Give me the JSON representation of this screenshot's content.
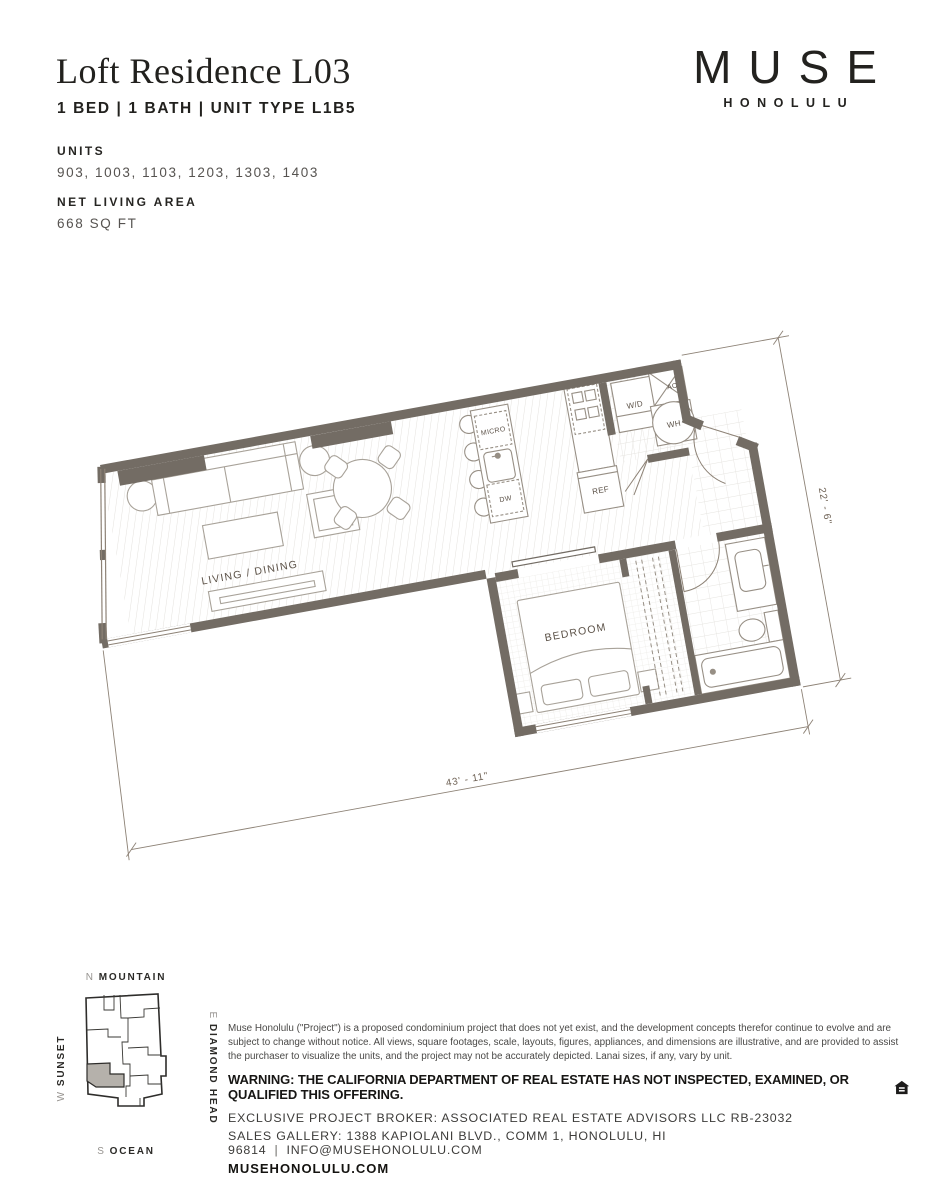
{
  "header": {
    "title": "Loft Residence L03",
    "subtitle": "1 BED | 1 BATH | UNIT TYPE L1B5",
    "units_label": "UNITS",
    "units_value": "903, 1003, 1103, 1203, 1303, 1403",
    "net_area_label": "NET LIVING AREA",
    "net_area_value": "668 SQ FT"
  },
  "brand": {
    "name": "MUSE",
    "city": "HONOLULU"
  },
  "floorplan": {
    "rooms": {
      "living": "LIVING / DINING",
      "bedroom": "BEDROOM"
    },
    "appliances": {
      "micro": "MICRO",
      "dw": "DW",
      "ref": "REF",
      "wd": "W/D",
      "ac": "AC",
      "wh": "WH"
    },
    "dimensions": {
      "width": "43' - 11\"",
      "depth": "22' - 6\""
    },
    "colors": {
      "wall": "#736c64",
      "floor_line": "#e3e1dd",
      "fixture": "#978f85"
    }
  },
  "keyplan": {
    "north_letter": "N",
    "north_word": "MOUNTAIN",
    "east_letter": "E",
    "east_word": "DIAMOND HEAD",
    "south_letter": "S",
    "south_word": "OCEAN",
    "west_letter": "W",
    "west_word": "SUNSET"
  },
  "footer": {
    "disclaimer": "Muse Honolulu (\"Project\") is a proposed condominium project that does not yet exist, and the development concepts therefor continue to evolve and are subject to change without notice. All views, square footages, scale, layouts, figures, appliances, and dimensions are illustrative, and are provided to assist the purchaser to visualize the units, and the project may not be accurately depicted. Lanai sizes, if any, vary by unit.",
    "warning": "WARNING: THE CALIFORNIA DEPARTMENT OF REAL ESTATE HAS NOT INSPECTED, EXAMINED, OR QUALIFIED THIS OFFERING.",
    "broker": "EXCLUSIVE PROJECT BROKER: ASSOCIATED REAL ESTATE ADVISORS LLC RB-23032",
    "sales_gallery": "SALES GALLERY: 1388 KAPIOLANI BLVD., COMM 1, HONOLULU, HI 96814",
    "separator": "|",
    "email": "INFO@MUSEHONOLULU.COM",
    "website": "MUSEHONOLULU.COM"
  }
}
